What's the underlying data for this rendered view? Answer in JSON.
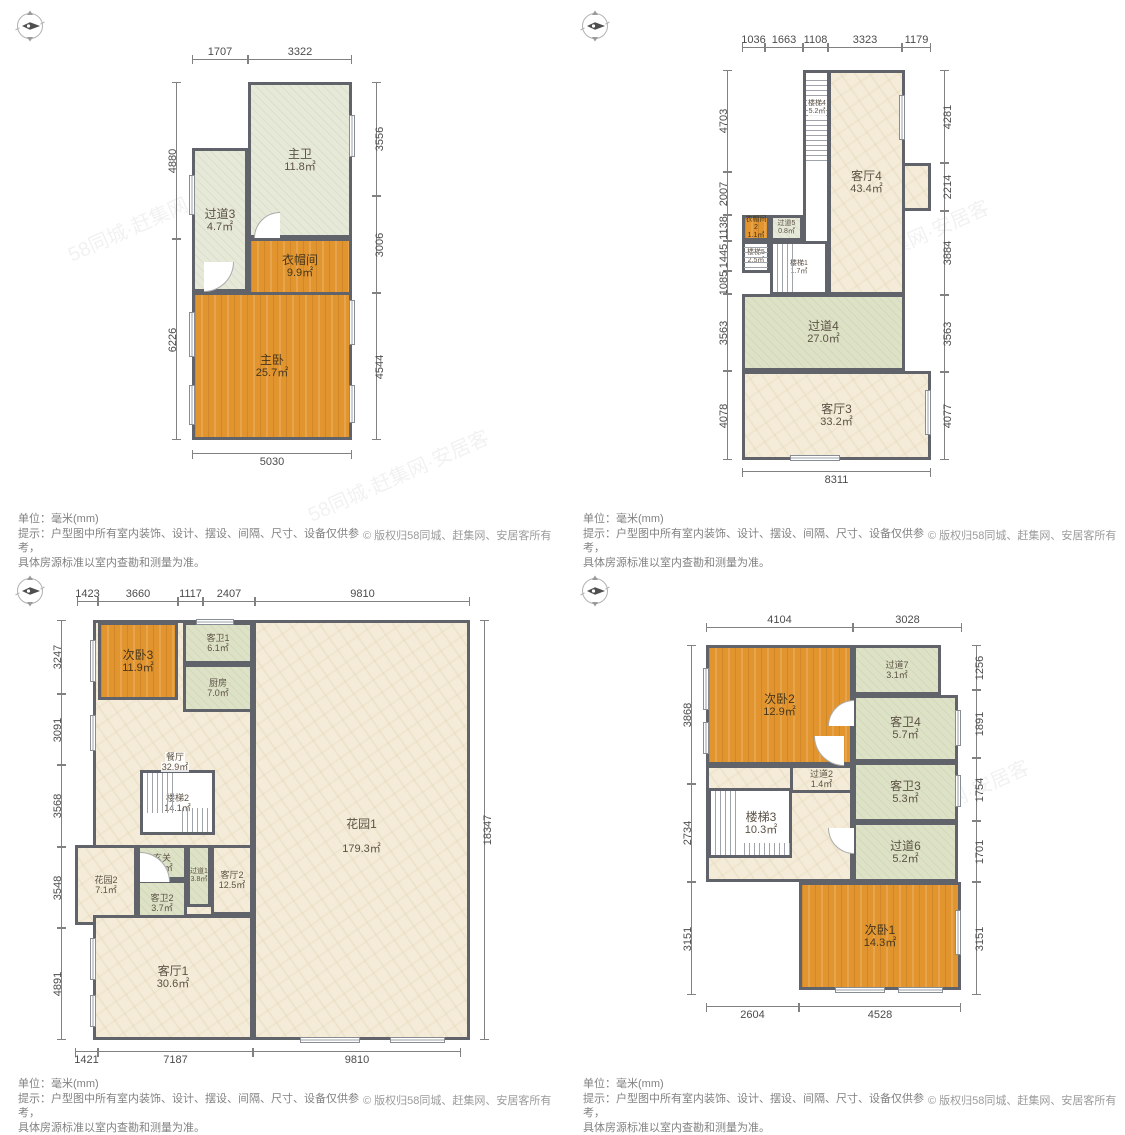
{
  "footer": {
    "unit": "单位：毫米(mm)",
    "tip1": "提示：户型图中所有室内装饰、设计、摆设、间隔、尺寸、设备仅供参考，",
    "tip2": "具体房源标准以室内查勘和测量为准。",
    "copyright": "© 版权归58同城、赶集网、安居客所有"
  },
  "watermark": "58同城·赶集网·安居客",
  "plans": {
    "p1": {
      "rooms": [
        {
          "name": "过道3",
          "area": "4.7㎡"
        },
        {
          "name": "主卫",
          "area": "11.8㎡"
        },
        {
          "name": "衣帽间",
          "area": "9.9㎡"
        },
        {
          "name": "主卧",
          "area": "25.7㎡"
        }
      ],
      "dims": {
        "top": [
          "1707",
          "3322"
        ],
        "left": [
          "4880",
          "6226"
        ],
        "right": [
          "3556",
          "3006",
          "4544"
        ],
        "bottom": [
          "5030"
        ]
      }
    },
    "p2": {
      "rooms": [
        {
          "name": "楼梯4",
          "area": "5.2㎡"
        },
        {
          "name": "客厅4",
          "area": "43.4㎡"
        },
        {
          "name": "衣帽间2",
          "area": "1.1㎡"
        },
        {
          "name": "过道5",
          "area": "0.8㎡"
        },
        {
          "name": "楼梯5",
          "area": "2.5㎡"
        },
        {
          "name": "楼梯1",
          "area": "1.7㎡"
        },
        {
          "name": "过道4",
          "area": "27.0㎡"
        },
        {
          "name": "客厅3",
          "area": "33.2㎡"
        }
      ],
      "dims": {
        "top": [
          "1036",
          "1663",
          "1108",
          "3323",
          "1179"
        ],
        "left": [
          "4703",
          "2007",
          "1138",
          "1445",
          "1085",
          "3563",
          "4078"
        ],
        "right": [
          "4281",
          "2214",
          "3884",
          "3563",
          "4077"
        ],
        "bottom": [
          "8311"
        ]
      }
    },
    "p3": {
      "rooms": [
        {
          "name": "次卧3",
          "area": "11.9㎡"
        },
        {
          "name": "客卫1",
          "area": "6.1㎡"
        },
        {
          "name": "厨房",
          "area": "7.0㎡"
        },
        {
          "name": "餐厅",
          "area": "32.9㎡"
        },
        {
          "name": "楼梯2",
          "area": "14.1㎡"
        },
        {
          "name": "花园2",
          "area": "7.1㎡"
        },
        {
          "name": "玄关",
          "area": "3.4㎡"
        },
        {
          "name": "过道1",
          "area": "3.8㎡"
        },
        {
          "name": "客卫2",
          "area": "3.7㎡"
        },
        {
          "name": "客厅2",
          "area": "12.5㎡"
        },
        {
          "name": "客厅1",
          "area": "30.6㎡"
        },
        {
          "name": "花园1",
          "area": "179.3㎡"
        }
      ],
      "dims": {
        "top": [
          "1423",
          "3660",
          "1117",
          "2407",
          "9810"
        ],
        "left": [
          "3247",
          "3091",
          "3568",
          "3548",
          "4891"
        ],
        "right": [
          "18347"
        ],
        "bottom": [
          "1421",
          "7187",
          "9810"
        ]
      }
    },
    "p4": {
      "rooms": [
        {
          "name": "次卧2",
          "area": "12.9㎡"
        },
        {
          "name": "过道7",
          "area": "3.1㎡"
        },
        {
          "name": "客卫4",
          "area": "5.7㎡"
        },
        {
          "name": "过道2",
          "area": "1.4㎡"
        },
        {
          "name": "客卫3",
          "area": "5.3㎡"
        },
        {
          "name": "楼梯3",
          "area": "10.3㎡"
        },
        {
          "name": "过道6",
          "area": "5.2㎡"
        },
        {
          "name": "次卧1",
          "area": "14.3㎡"
        }
      ],
      "dims": {
        "top": [
          "4104",
          "3028"
        ],
        "left": [
          "3868",
          "2734",
          "3151"
        ],
        "right": [
          "1256",
          "1891",
          "1754",
          "1701",
          "3151"
        ],
        "bottom": [
          "2604",
          "4528"
        ]
      }
    }
  }
}
